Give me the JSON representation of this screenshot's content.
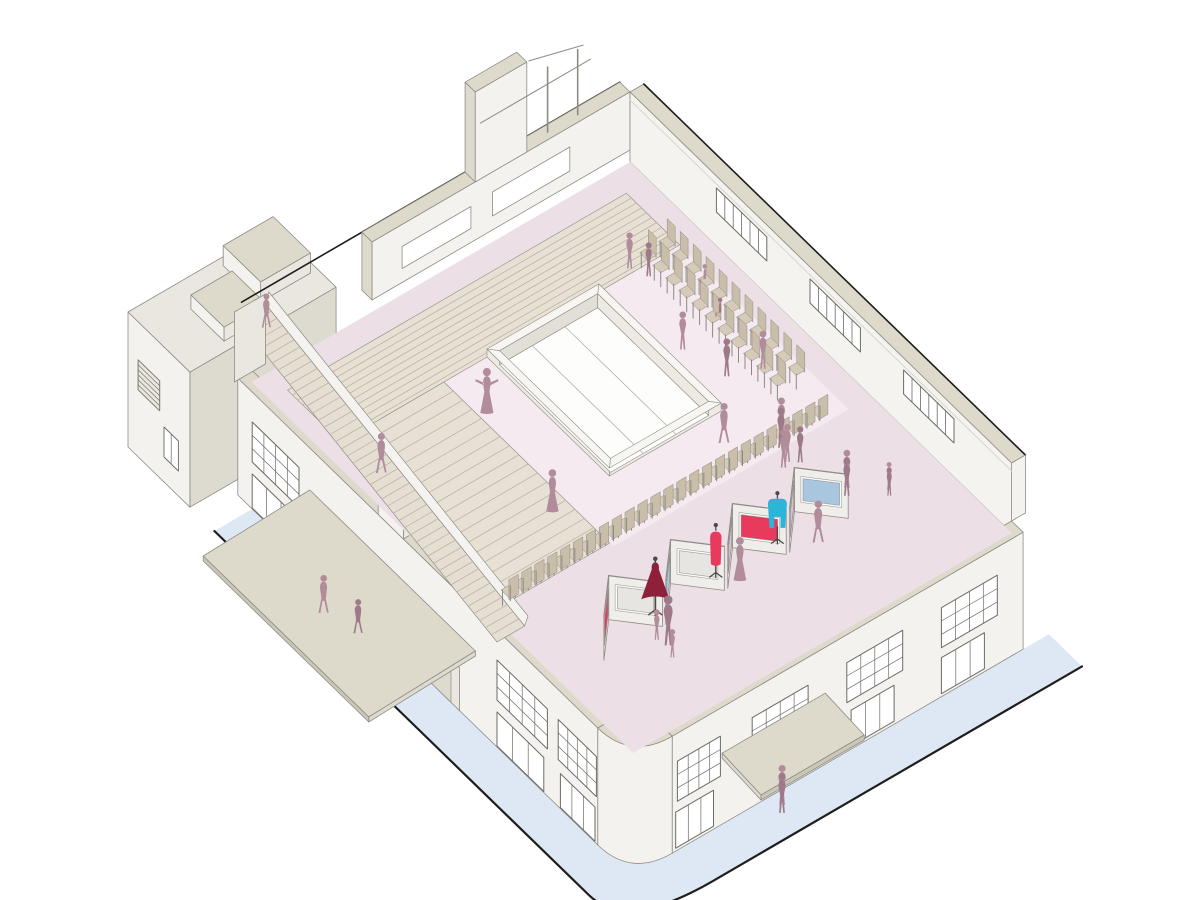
{
  "illustration": {
    "kind": "axonometric-cutaway-building-illustration",
    "subject": "exhibition hall interior with runway seating, zigzag display panels, mannequins and visitor figures",
    "canvas": {
      "width": 1200,
      "height": 900
    }
  },
  "palette": {
    "background": "#ffffff",
    "wallFace": "#f3f2ee",
    "wallFaceShade": "#e9e7e0",
    "wallSliver": "#dddacf",
    "coping": "#ddd9cb",
    "copingShade": "#cbc7b8",
    "neInterior": "#f5f3f0",
    "floor": "#ecdfe6",
    "floorLight": "#f4eaef",
    "steps": "#e7e0d5",
    "stepLine": "#b9ad9c",
    "stairFill": "#e5ded2",
    "stringer": "#f4f3ef",
    "voidTop": "#f7f6f2",
    "voidInnerA": "#eceae3",
    "voidInnerB": "#e2dfd7",
    "glassWhite": "#fdfdfc",
    "chairSeat": "#d5cbb8",
    "chairBack": "#c9bea9",
    "chairFrame": "#8d8a84",
    "panelFace": "#f0eeea",
    "panelShade": "#dcd8cf",
    "artFrame": "#fafaf9",
    "red": "#e73a5d",
    "darkRed": "#8e2139",
    "blue": "#a9c6df",
    "pinkArt": "#d9bfcb",
    "grayArt": "#e7e5e2",
    "cyan": "#2ab5d9",
    "figure": "#b18c9a",
    "figureDark": "#9e7a89",
    "sidewalk": "#dde8f4",
    "groundLine": "#1f1e1c",
    "outline": "#57544e",
    "outlineSoft": "#8f8c85",
    "mullion": "#6e6b66",
    "windowWhite": "#ffffff",
    "grille": "#7a776f"
  },
  "scene": {
    "projection": {
      "origin": [
        630,
        92
      ],
      "u": [
        0.72,
        0.7
      ],
      "v": [
        -0.86,
        0.5
      ],
      "parapetZ": 70,
      "streetZ": -105
    },
    "hall": {
      "lengthX": 530,
      "widthY": 440,
      "wallThickness": 16,
      "lowParapetZ": 12
    },
    "skylightVoid": {
      "x0": 100,
      "x1": 270,
      "y0": 120,
      "y1": 250,
      "curb": 8,
      "pitZ": -6,
      "glazingLinesY": [
        166,
        204
      ]
    },
    "amphitheater": {
      "nwBand": {
        "x0": 26,
        "x1": 100,
        "y0": 26,
        "y1": 420,
        "stripeStep": 7
      },
      "westBand": {
        "x0": 100,
        "x1": 330,
        "y0": 300,
        "y1": 420,
        "stripeStep": 13
      }
    },
    "staircase": {
      "x0": 0,
      "x1": 360,
      "y0": 424,
      "y1": 456,
      "topZ": 70,
      "stripeStep": 8
    },
    "neWindows": {
      "list": [
        [
          120,
          190
        ],
        [
          250,
          320
        ],
        [
          380,
          450
        ]
      ],
      "z": [
        34,
        58
      ],
      "bars": 5
    },
    "seFacade": {
      "upperWindows": [
        [
          30,
          95
        ],
        [
          140,
          205
        ],
        [
          250,
          315
        ],
        [
          352,
          402
        ]
      ],
      "upperZ": [
        -16,
        -56
      ],
      "lowerWindows": [
        [
          45,
          95
        ],
        [
          150,
          200
        ],
        [
          360,
          404
        ]
      ],
      "lowerZ": [
        -66,
        -102
      ],
      "canopy": {
        "y0": 230,
        "y1": 350,
        "depth": 54,
        "z": -34
      }
    },
    "swFacade": {
      "upperWindows": [
        [
          360,
          430
        ],
        [
          445,
          498
        ],
        [
          20,
          85
        ]
      ],
      "upperZ": [
        -18,
        -58
      ],
      "lowerWindows": [
        [
          360,
          425
        ],
        [
          448,
          496
        ],
        [
          20,
          80
        ]
      ],
      "lowerZ": [
        -70,
        -104
      ],
      "doors": {
        "x0": 140,
        "x1": 300,
        "z": [
          -68,
          -105
        ],
        "panels": 3
      },
      "canopy": {
        "x0": 100,
        "x1": 330,
        "depth": 124,
        "z": -30
      },
      "roofBoxes": [
        {
          "x0": 195,
          "x1": 230,
          "h": 22
        },
        {
          "x0": 320,
          "x1": 350,
          "h": 18
        }
      ]
    },
    "rearWing": {
      "x0": -100,
      "x1": -14,
      "y0": 330,
      "y1": 500,
      "topZ": 30,
      "grille": {
        "x0": -86,
        "x1": -56,
        "z0": -8,
        "z1": -38,
        "lines": 6
      },
      "window": {
        "x0": -50,
        "x1": -30,
        "z0": -50,
        "z1": -80
      },
      "roofBoxes": [
        {
          "x0": -92,
          "x1": -40,
          "y0": 338,
          "y1": 396,
          "h": 20
        },
        {
          "x0": -70,
          "x1": -24,
          "y0": 404,
          "y1": 452,
          "h": 14
        }
      ]
    },
    "nwWall": {
      "x0": -14,
      "x1": 0,
      "y1": 300,
      "ribbons": [
        {
          "y0": 70,
          "y1": 160,
          "z0": 26,
          "z1": 50
        },
        {
          "y0": 185,
          "y1": 265,
          "z0": 26,
          "z1": 48
        }
      ],
      "fin": {
        "y0": 120,
        "y1": 180,
        "topZ": 160
      },
      "posts": [
        55,
        90
      ]
    },
    "chairs": {
      "topBlock": {
        "x0": 105,
        "dx": 18,
        "count": 11,
        "rowsY": [
          44,
          66
        ]
      },
      "runwayRow": {
        "x": 335,
        "y0": 60,
        "dy": 15,
        "count": 25
      }
    },
    "displayPanels": {
      "xFront": 432,
      "xApex": 398,
      "halfSpan": 34,
      "height": 44,
      "yCenters": [
        358,
        286,
        214,
        142
      ],
      "artworks": [
        [
          "red",
          "grayArt"
        ],
        [
          "blue",
          "grayArt"
        ],
        [
          "pinkArt",
          "red"
        ],
        [
          "pinkArt",
          "blue"
        ]
      ]
    },
    "mannequins": [
      {
        "type": "gown",
        "color": "darkRed",
        "x": 415,
        "y": 318,
        "h": 58
      },
      {
        "type": "sheath",
        "color": "red",
        "x": 413,
        "y": 246,
        "h": 54
      },
      {
        "type": "coat",
        "color": "cyan",
        "x": 415,
        "y": 176,
        "h": 52
      }
    ],
    "figures": [
      {
        "t": "stand",
        "x": 95,
        "y": 80,
        "z": 0,
        "h": 36,
        "c": "figure"
      },
      {
        "t": "stand",
        "x": 112,
        "y": 72,
        "z": 0,
        "h": 34,
        "c": "figureDark"
      },
      {
        "t": "seated",
        "x": 160,
        "y": 48,
        "z": 15,
        "h": 27,
        "c": "figure"
      },
      {
        "t": "seated",
        "x": 198,
        "y": 62,
        "z": 15,
        "h": 27,
        "c": "figureDark"
      },
      {
        "t": "stand",
        "x": 195,
        "y": 102,
        "z": 0,
        "h": 38,
        "c": "figure"
      },
      {
        "t": "stand",
        "x": 242,
        "y": 90,
        "z": 0,
        "h": 38,
        "c": "figureDark"
      },
      {
        "t": "stand",
        "x": 254,
        "y": 58,
        "z": 0,
        "h": 38,
        "c": "figure"
      },
      {
        "t": "walk",
        "x": 300,
        "y": 142,
        "z": 0,
        "h": 40,
        "c": "figure"
      },
      {
        "t": "dressArms",
        "x": 150,
        "y": 292,
        "z": 0,
        "h": 46,
        "c": "figure"
      },
      {
        "t": "dress",
        "x": 272,
        "y": 318,
        "z": 0,
        "h": 43,
        "c": "figure"
      },
      {
        "t": "walk",
        "x": 180,
        "y": 440,
        "z": 35,
        "h": 40,
        "c": "figure"
      },
      {
        "t": "walk",
        "x": 18,
        "y": 438,
        "z": 66,
        "h": 34,
        "c": "figure"
      },
      {
        "t": "stand",
        "x": 325,
        "y": 96,
        "z": 0,
        "h": 40,
        "c": "figure"
      },
      {
        "t": "stand",
        "x": 334,
        "y": 104,
        "z": 0,
        "h": 40,
        "c": "figureDark"
      },
      {
        "t": "stand",
        "x": 350,
        "y": 110,
        "z": 0,
        "h": 38,
        "c": "figure"
      },
      {
        "t": "stand",
        "x": 357,
        "y": 101,
        "z": 0,
        "h": 36,
        "c": "figureDark"
      },
      {
        "t": "stand",
        "x": 353,
        "y": 117,
        "z": 0,
        "h": 38,
        "c": "figure"
      },
      {
        "t": "stand",
        "x": 404,
        "y": 86,
        "z": 0,
        "h": 38,
        "c": "figure"
      },
      {
        "t": "stand",
        "x": 411,
        "y": 92,
        "z": 0,
        "h": 38,
        "c": "figureDark"
      },
      {
        "t": "stand",
        "x": 428,
        "y": 57,
        "z": 0,
        "h": 28,
        "c": "figure"
      },
      {
        "t": "stand",
        "x": 433,
        "y": 61,
        "z": 0,
        "h": 28,
        "c": "figureDark"
      },
      {
        "t": "walk",
        "x": 438,
        "y": 148,
        "z": 0,
        "h": 42,
        "c": "figure"
      },
      {
        "t": "dress",
        "x": 431,
        "y": 233,
        "z": 0,
        "h": 44,
        "c": "figure"
      },
      {
        "t": "stand",
        "x": 452,
        "y": 334,
        "z": 0,
        "h": 50,
        "c": "figureDark"
      },
      {
        "t": "child",
        "x": 441,
        "y": 338,
        "z": 0,
        "h": 30,
        "c": "figure"
      },
      {
        "t": "child",
        "x": 465,
        "y": 340,
        "z": 0,
        "h": 28,
        "c": "figure"
      },
      {
        "t": "walk",
        "x": 150,
        "y": 482,
        "z": -105,
        "h": 38,
        "c": "figure"
      },
      {
        "t": "walk",
        "x": 186,
        "y": 472,
        "z": -105,
        "h": 34,
        "c": "figureDark"
      },
      {
        "t": "stand",
        "x": 560,
        "y": 292,
        "z": -105,
        "h": 40,
        "c": "figure"
      },
      {
        "t": "stand",
        "x": 567,
        "y": 298,
        "z": -105,
        "h": 40,
        "c": "figureDark"
      }
    ]
  }
}
